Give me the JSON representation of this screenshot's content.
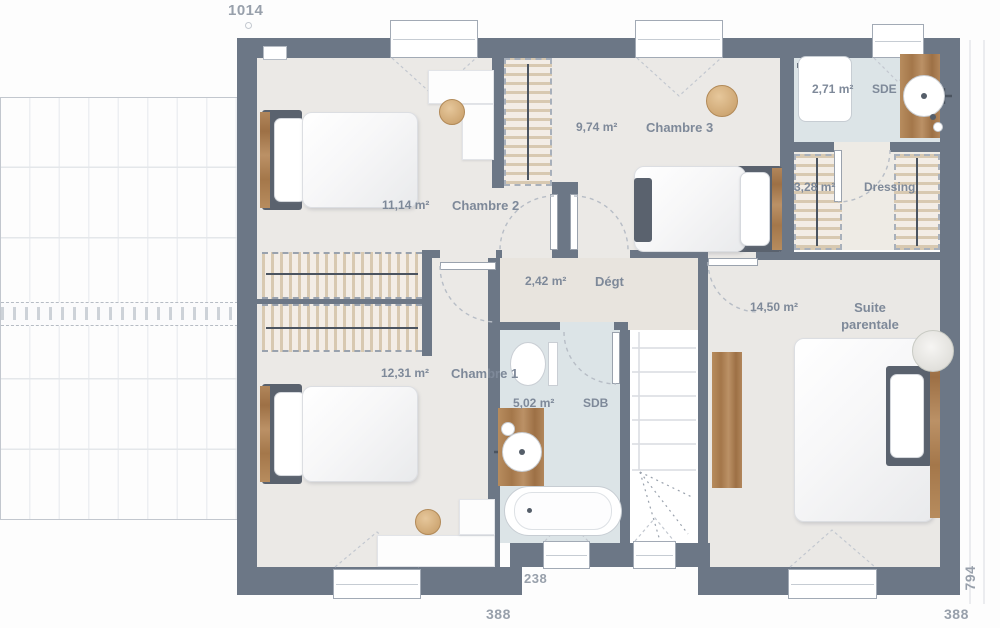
{
  "plan": {
    "dimensions": {
      "width_top": "1014",
      "notch_bottom": "238",
      "bottom_left": "388",
      "bottom_right": "388",
      "height_right": "794"
    },
    "rooms": [
      {
        "id": "chambre2",
        "name": "Chambre 2",
        "area": "11,14 m²"
      },
      {
        "id": "chambre3",
        "name": "Chambre 3",
        "area": "9,74 m²"
      },
      {
        "id": "sde",
        "name": "SDE",
        "area": "2,71 m²"
      },
      {
        "id": "dressing",
        "name": "Dressing",
        "area": "3,28 m²"
      },
      {
        "id": "degt",
        "name": "Dégt",
        "area": "2,42 m²"
      },
      {
        "id": "suite",
        "name": "Suite parentale",
        "area": "14,50 m²"
      },
      {
        "id": "chambre1",
        "name": "Chambre 1",
        "area": "12,31 m²"
      },
      {
        "id": "sdb",
        "name": "SDB",
        "area": "5,02 m²"
      }
    ],
    "colors": {
      "wall": "#6c7786",
      "floor": "#ebe9e6",
      "hall": "#e8e4de",
      "bath": "#dce4e7",
      "dressing_floor": "#eeebe5",
      "wood": "#ab7e51",
      "hatch": "#d5c7b0",
      "label": "#7e8999",
      "dim": "#98a0ab"
    }
  }
}
